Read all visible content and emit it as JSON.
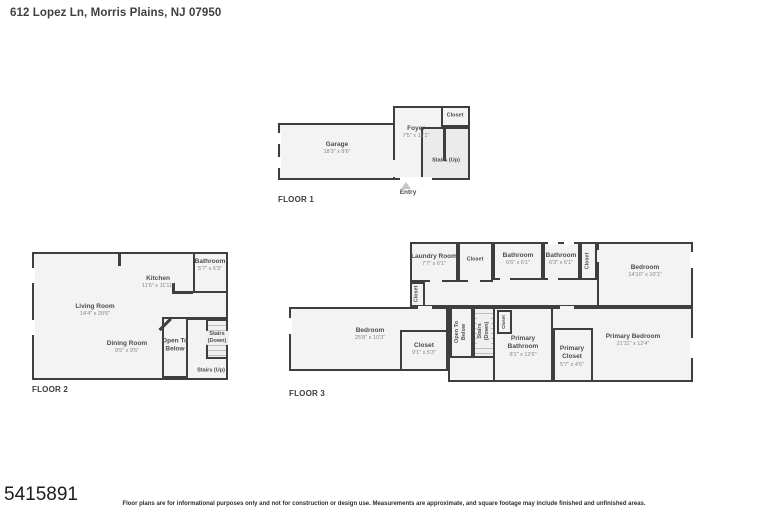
{
  "header": {
    "title": "612 Lopez Ln, Morris Plains, NJ 07950"
  },
  "floor1": {
    "label": "FLOOR 1",
    "entry_label": "Entry",
    "rooms": {
      "garage": {
        "name": "Garage",
        "dims": "18'3\" x 8'6\""
      },
      "foyer": {
        "name": "Foyer",
        "dims": "7'5\" x 11'1\""
      },
      "closet": {
        "name": "Closet"
      },
      "stairs": {
        "name": "Stairs (Up)"
      }
    }
  },
  "floor2": {
    "label": "FLOOR 2",
    "rooms": {
      "living": {
        "name": "Living Room",
        "dims": "14'4\" x 20'6\""
      },
      "kitchen": {
        "name": "Kitchen",
        "dims": "11'6\" x 11'11\""
      },
      "bathroom": {
        "name": "Bathroom",
        "dims": "5'7\" x 6'3\""
      },
      "dining": {
        "name": "Dining Room",
        "dims": "9'5\" x 9'5\""
      },
      "open_below": {
        "name": "Open To Below"
      },
      "stairs_down": {
        "name": "Stairs (Down)"
      },
      "stairs_up": {
        "name": "Stairs (Up)"
      }
    }
  },
  "floor3": {
    "label": "FLOOR 3",
    "rooms": {
      "laundry": {
        "name": "Laundry Room",
        "dims": "7'7\" x 6'1\""
      },
      "closet_top": {
        "name": "Closet"
      },
      "bathroom1": {
        "name": "Bathroom",
        "dims": "6'6\" x 6'1\""
      },
      "bathroom2": {
        "name": "Bathroom",
        "dims": "6'3\" x 6'1\""
      },
      "closet_strip": {
        "name": "Closet"
      },
      "bedroom2": {
        "name": "Bedroom",
        "dims": "14'10\" x 10'1\""
      },
      "closet_hall": {
        "name": "Closet"
      },
      "bedroom1": {
        "name": "Bedroom",
        "dims": "25'8\" x 10'3\""
      },
      "closet_bedroom": {
        "name": "Closet",
        "dims": "9'1\" x 5'3\""
      },
      "open_below": {
        "name": "Open To Below"
      },
      "stairs_down": {
        "name": "Stairs (Down)"
      },
      "closet_small": {
        "name": "Closet"
      },
      "primary_bathroom": {
        "name": "Primary Bathroom",
        "dims": "8'1\" x 12'6\""
      },
      "primary_closet": {
        "name": "Primary Closet",
        "dims": "5'7\" x 4'5\""
      },
      "primary_bedroom": {
        "name": "Primary Bedroom",
        "dims": "21'11\" x 12'4\""
      }
    }
  },
  "footer": {
    "mls_number": "5415891",
    "disclaimer": "Floor plans are for informational purposes only and not for construction or design use. Measurements are approximate, and square footage may include finished and unfinished areas."
  }
}
